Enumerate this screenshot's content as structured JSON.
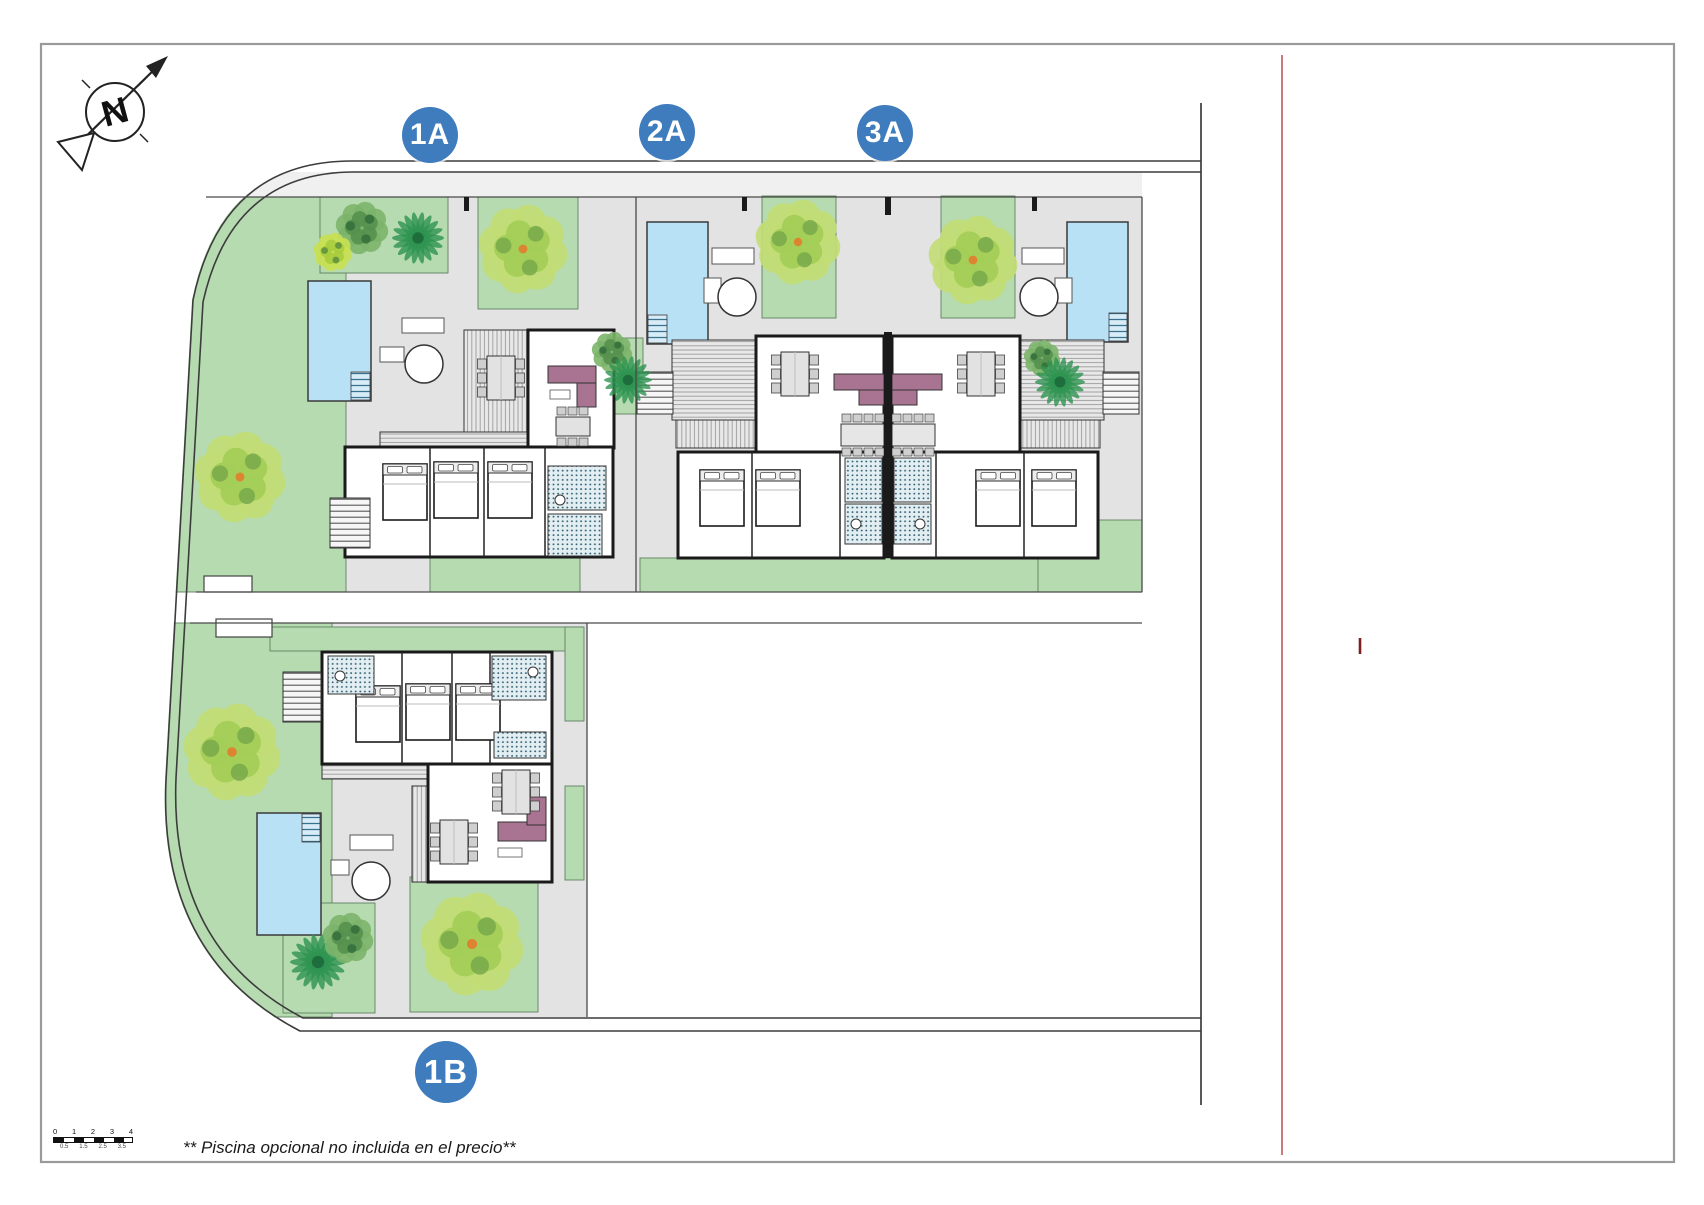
{
  "villas": [
    {
      "label": "1A"
    },
    {
      "label": "2A"
    },
    {
      "label": "3A"
    },
    {
      "label": "1B"
    }
  ],
  "compass": {
    "letter": "N"
  },
  "footnote": "** Piscina opcional no incluida en el precio**",
  "scalebar": {
    "top": [
      "0",
      "1",
      "2",
      "3",
      "4"
    ],
    "bottom": [
      "0.5",
      "1.5",
      "2.5",
      "3.5"
    ]
  },
  "colors": {
    "label_blue": "#3f7cbd",
    "pool": "#b9e1f5",
    "pool_ladder": "#39718f",
    "garden": "#b6dbb0",
    "paving": "#e3e3e3",
    "path": "#f0f0f0",
    "road": "#ffffff",
    "sofa": "#a87492",
    "wall": "#1a1a1a",
    "boundary": "#3c3c3c",
    "red_line": "#b34040",
    "red_tick": "#7a2020",
    "frame": "#9a9a9a",
    "bath_tile": "#2f6172",
    "bath_bg": "#e3eef2",
    "tree_yellow": "#c2dd74",
    "tree_yellow_mid": "#a3cd56",
    "tree_yellow_dark": "#78a94b",
    "tree_center_dot": "#dd8430",
    "tree_dark": "#7cb46a",
    "tree_dark_mid": "#55904f",
    "tree_dark_deep": "#346d3a",
    "tree_lime": "#c8e052",
    "tree_lime_mid": "#a8cc3f",
    "palm": "#2e9350",
    "palm_center": "#1d6e3c"
  }
}
